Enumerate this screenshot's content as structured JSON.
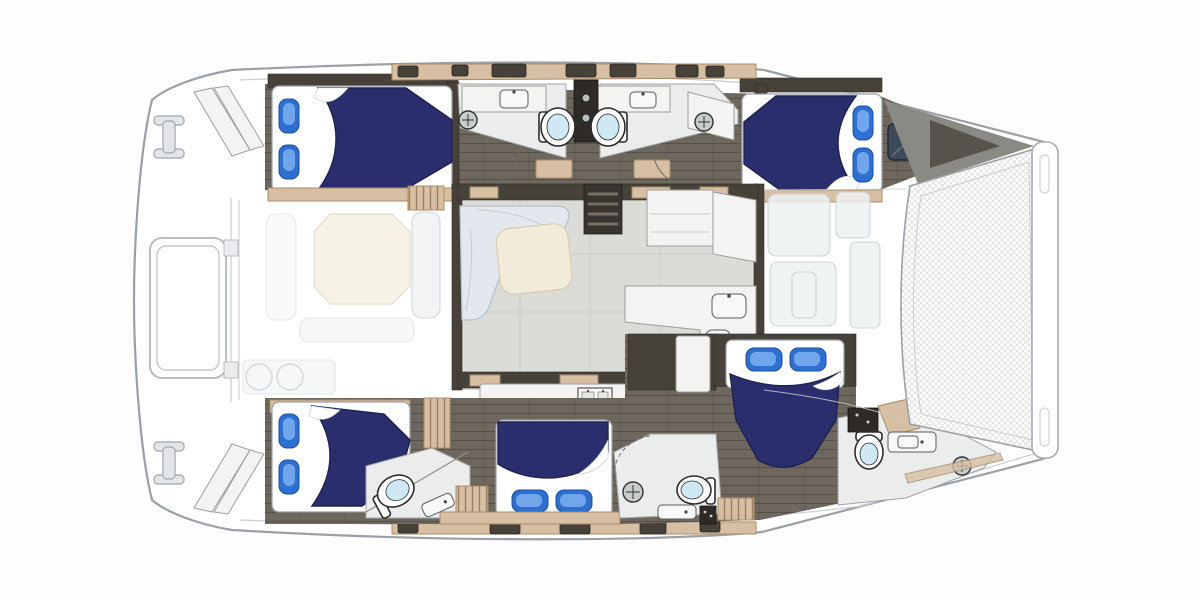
{
  "meta": {
    "title": "Catamaran yacht floor plan — overhead view, 5-cabin layout",
    "view": "top-down deck/accommodation plan",
    "orientation": {
      "bow": "right",
      "stern": "left"
    },
    "canvas": {
      "width": 1200,
      "height": 600
    }
  },
  "vessel": {
    "kind": "sailing catamaran",
    "inventory": {
      "double_berths": 5,
      "pillows": 10,
      "toilets": 5,
      "bathroom_sinks": 5,
      "shower_drains": 4,
      "galley_sinks": 2,
      "stoves": 1,
      "companionway_stairs": 2,
      "salon_sofa": 1,
      "salon_table": 1,
      "bow_trampoline": 1,
      "stern_davit_frame": 1,
      "transom_step_sets": 2,
      "mooring_cleats": 2,
      "deck_hatches": 12,
      "cabin_window_hatches": 1
    },
    "cabins": [
      {
        "id": "port-aft-cabin",
        "position": "top-left",
        "bed_head": "left"
      },
      {
        "id": "port-fwd-cabin",
        "position": "top-right",
        "bed_head": "right"
      },
      {
        "id": "stbd-aft-cabin",
        "position": "bottom-left",
        "bed_head": "left"
      },
      {
        "id": "stbd-mid-cabin",
        "position": "bottom-center",
        "bed_head": "bottom"
      },
      {
        "id": "stbd-fwd-cabin",
        "position": "center-right",
        "bed_head": "top"
      }
    ],
    "shared_spaces": [
      {
        "id": "salon",
        "position": "center",
        "contents": [
          "l-sofa",
          "table",
          "galley-counters",
          "fridge",
          "stove"
        ]
      },
      {
        "id": "aft-cockpit",
        "position": "left",
        "rendering": "ghosted",
        "contents": [
          "table",
          "benches",
          "grill"
        ]
      },
      {
        "id": "foredeck-lounge",
        "position": "right-of-salon",
        "rendering": "ghosted"
      }
    ]
  },
  "icons": {
    "shower-drain-icon": "circle with center cross",
    "cleat-icon": "I-beam shape",
    "stairs-icon": "dark block with rung lines",
    "sink-icon": "rounded rectangle with faucet dot",
    "toilet-icon": "oval bowl with pale-blue lid"
  },
  "colors": {
    "hull_fill": "#ffffff",
    "hull_stroke": "#9aa0a6",
    "deck_line": "#c8cccf",
    "floor_dark": "#6e675e",
    "wall": "#474239",
    "locker": "#2e2b27",
    "wood_tan": "#d7bfa3",
    "wood_trim": "#a88b68",
    "salon_floor": "#dbdbd8",
    "counter": "#f3f3f1",
    "counter_stroke": "#9d9d9a",
    "sofa": "#e2e8ee",
    "sofa_stroke": "#b7c2cc",
    "table": "#f2ebd9",
    "table_stroke": "#d6cdb6",
    "duvet": "#2b2e6d",
    "duvet_stroke": "#1e2152",
    "pillow": "#2e6fd2",
    "pillow_light": "#7db0ef",
    "toilet_lid": "#cfe9f4",
    "window": "#3c4956",
    "mesh_line": "#d9d9d9",
    "ghost_fill": "#eef1f3",
    "ghost_stroke": "#c9cfd4",
    "stair": "#38342f",
    "stair_step": "#756d62"
  }
}
